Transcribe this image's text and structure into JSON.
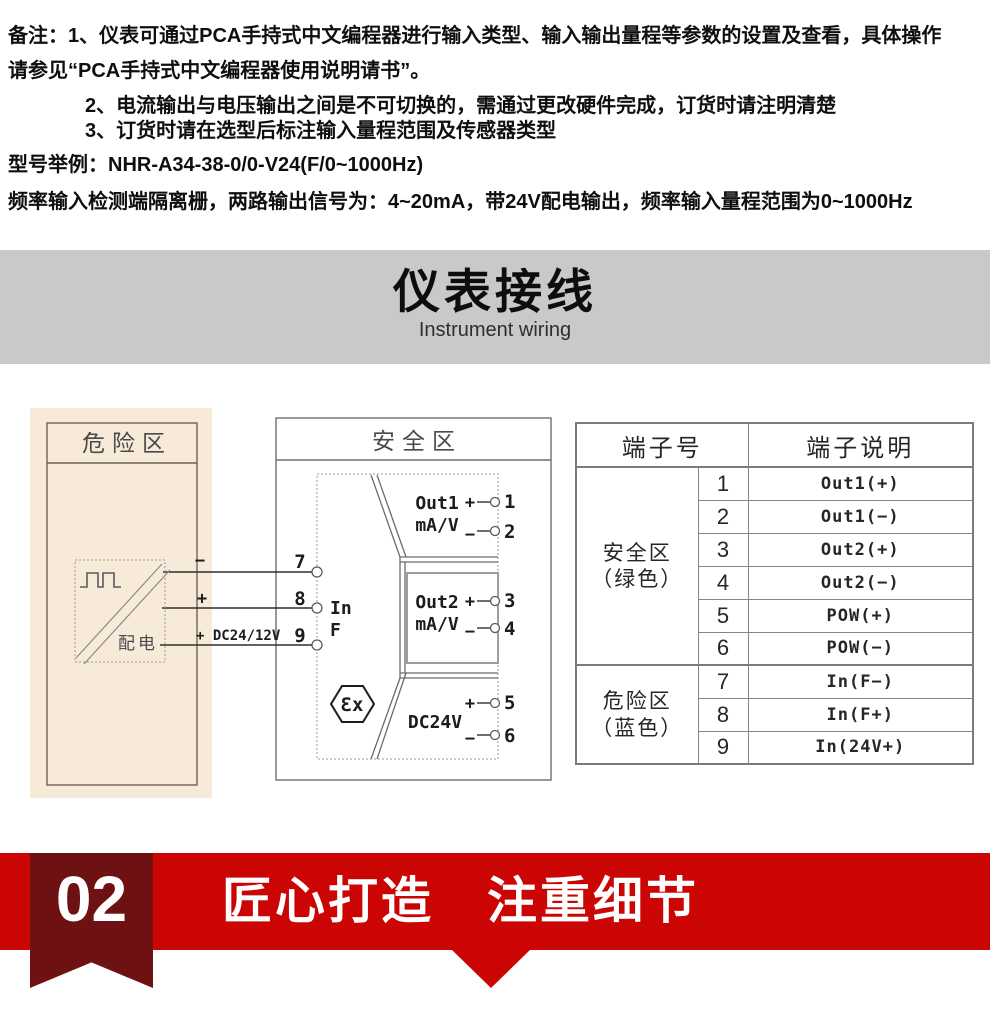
{
  "notes": {
    "line1": "备注：1、仪表可通过PCA手持式中文编程器进行输入类型、输入输出量程等参数的设置及查看，具体操作",
    "line2": "请参见“PCA手持式中文编程器使用说明请书”。",
    "line3": "2、电流输出与电压输出之间是不可切换的，需通过更改硬件完成，订货时请注明清楚",
    "line4": "3、订货时请在选型后标注输入量程范围及传感器类型",
    "line5": "型号举例：NHR-A34-38-0/0-V24(F/0~1000Hz)",
    "line6": "频率输入检测端隔离栅，两路输出信号为：4~20mA，带24V配电输出，频率输入量程范围为0~1000Hz"
  },
  "banner": {
    "title": "仪表接线",
    "subtitle": "Instrument wiring"
  },
  "diagram": {
    "hazard": {
      "title": "危险区",
      "power_label": "配电",
      "wire1_label": "−",
      "wire2_label": "+",
      "wire3_label": "+ DC24/12V"
    },
    "safe": {
      "title": "安全区",
      "t7": "7",
      "t8": "8",
      "t9": "9",
      "in_line1": "In",
      "in_line2": "F",
      "out1_name": "Out1",
      "out1_unit": "mA/V",
      "out1_plus": "+",
      "out1_minus": "−",
      "t1": "1",
      "t2": "2",
      "out2_name": "Out2",
      "out2_unit": "mA/V",
      "out2_plus": "+",
      "out2_minus": "−",
      "t3": "3",
      "t4": "4",
      "pow_name": "DC24V",
      "pow_plus": "+",
      "pow_minus": "−",
      "t5": "5",
      "t6": "6",
      "ex": "Ɛx"
    }
  },
  "terminal_table": {
    "header_no": "端子号",
    "header_desc": "端子说明",
    "group1_line1": "安全区",
    "group1_line2": "（绿色）",
    "group2_line1": "危险区",
    "group2_line2": "（蓝色）",
    "rows": [
      {
        "num": "1",
        "desc": "Out1(+)"
      },
      {
        "num": "2",
        "desc": "Out1(−)"
      },
      {
        "num": "3",
        "desc": "Out2(+)"
      },
      {
        "num": "4",
        "desc": "Out2(−)"
      },
      {
        "num": "5",
        "desc": "POW(+)"
      },
      {
        "num": "6",
        "desc": "POW(−)"
      },
      {
        "num": "7",
        "desc": "In(F−)"
      },
      {
        "num": "8",
        "desc": "In(F+)"
      },
      {
        "num": "9",
        "desc": "In(24V+)"
      }
    ]
  },
  "footer": {
    "number": "02",
    "title": "匠心打造　注重细节"
  },
  "colors": {
    "accent_red": "#cb0404",
    "ribbon_dark_red": "#6e1113",
    "banner_gray": "#c9c9c9",
    "panel_beige": "#f8ead9"
  }
}
